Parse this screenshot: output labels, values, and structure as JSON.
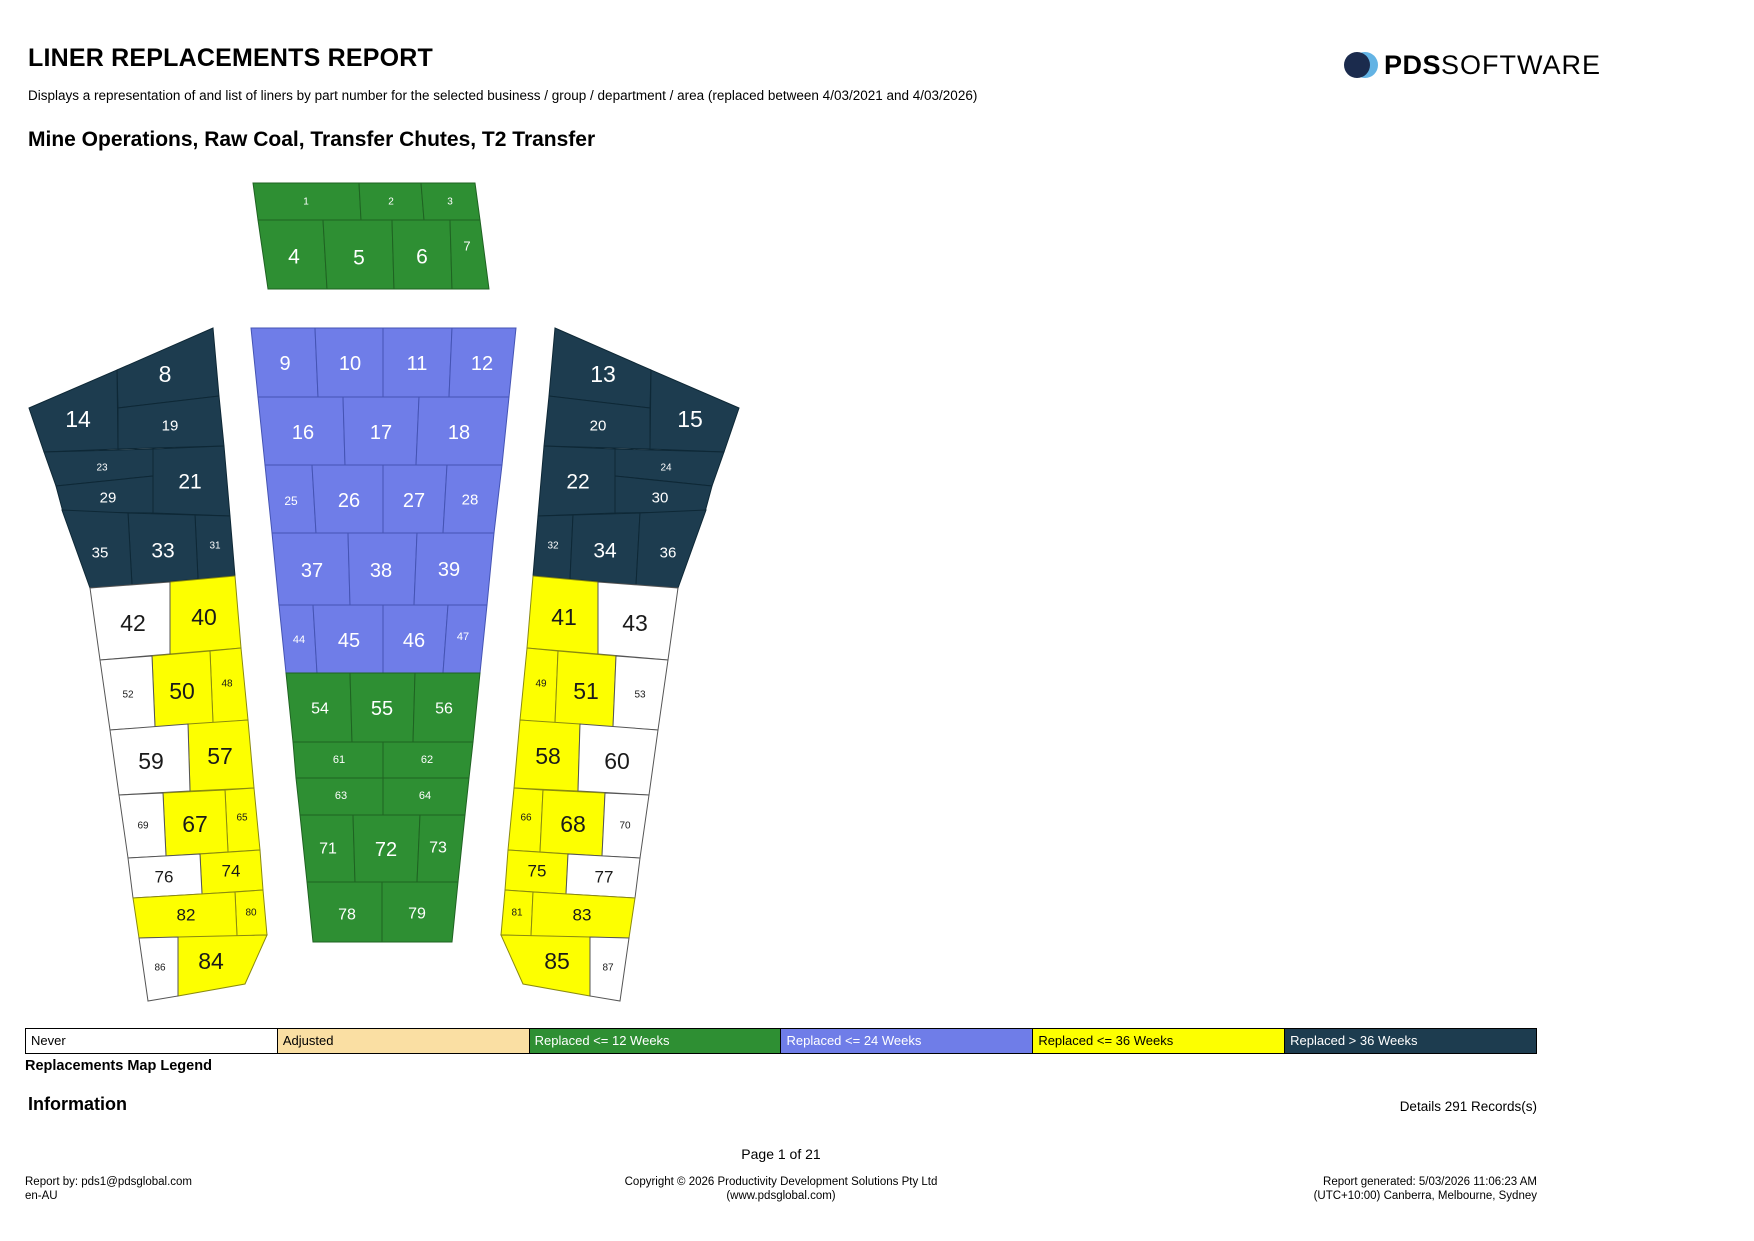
{
  "report": {
    "title": "LINER REPLACEMENTS REPORT",
    "subtitle": "Displays a representation of and list of liners by part number for the selected business / group / department / area (replaced between 4/03/2021 and 4/03/2026)",
    "section_title": "Mine Operations, Raw Coal, Transfer Chutes, T2 Transfer"
  },
  "logo": {
    "pds": "PDS",
    "software": "SOFTWARE",
    "navy": "#1b2b4d",
    "light_blue": "#63b3e4"
  },
  "legend": {
    "title": "Replacements Map Legend",
    "items": [
      {
        "label": "Never",
        "bg": "#ffffff",
        "text": "#000000"
      },
      {
        "label": "Adjusted",
        "bg": "#fadfa3",
        "text": "#000000"
      },
      {
        "label": "Replaced <= 12 Weeks",
        "bg": "#2e8f33",
        "text": "#ffffff"
      },
      {
        "label": "Replaced <= 24 Weeks",
        "bg": "#6f7de8",
        "text": "#ffffff"
      },
      {
        "label": "Replaced <= 36 Weeks",
        "bg": "#fdff00",
        "text": "#000000"
      },
      {
        "label": "Replaced >  36 Weeks",
        "bg": "#1d3c4f",
        "text": "#ffffff"
      }
    ]
  },
  "map": {
    "statuses": {
      "never": "#ffffff",
      "adjusted": "#fadfa3",
      "r12": "#2e8f33",
      "r24": "#6f7de8",
      "r36": "#fdff00",
      "r36plus": "#1d3c4f"
    },
    "cells": [
      {
        "n": 1,
        "status": "r12"
      },
      {
        "n": 2,
        "status": "r12"
      },
      {
        "n": 3,
        "status": "r12"
      },
      {
        "n": 4,
        "status": "r12"
      },
      {
        "n": 5,
        "status": "r12"
      },
      {
        "n": 6,
        "status": "r12"
      },
      {
        "n": 7,
        "status": "r12"
      },
      {
        "n": 8,
        "status": "r36plus"
      },
      {
        "n": 9,
        "status": "r24"
      },
      {
        "n": 10,
        "status": "r24"
      },
      {
        "n": 11,
        "status": "r24"
      },
      {
        "n": 12,
        "status": "r24"
      },
      {
        "n": 13,
        "status": "r36plus"
      },
      {
        "n": 14,
        "status": "r36plus"
      },
      {
        "n": 15,
        "status": "r36plus"
      },
      {
        "n": 16,
        "status": "r24"
      },
      {
        "n": 17,
        "status": "r24"
      },
      {
        "n": 18,
        "status": "r24"
      },
      {
        "n": 19,
        "status": "r36plus"
      },
      {
        "n": 20,
        "status": "r36plus"
      },
      {
        "n": 21,
        "status": "r36plus"
      },
      {
        "n": 22,
        "status": "r36plus"
      },
      {
        "n": 23,
        "status": "r36plus"
      },
      {
        "n": 24,
        "status": "r36plus"
      },
      {
        "n": 25,
        "status": "r24"
      },
      {
        "n": 26,
        "status": "r24"
      },
      {
        "n": 27,
        "status": "r24"
      },
      {
        "n": 28,
        "status": "r24"
      },
      {
        "n": 29,
        "status": "r36plus"
      },
      {
        "n": 30,
        "status": "r36plus"
      },
      {
        "n": 31,
        "status": "r36plus"
      },
      {
        "n": 32,
        "status": "r36plus"
      },
      {
        "n": 33,
        "status": "r36plus"
      },
      {
        "n": 34,
        "status": "r36plus"
      },
      {
        "n": 35,
        "status": "r36plus"
      },
      {
        "n": 36,
        "status": "r36plus"
      },
      {
        "n": 37,
        "status": "r24"
      },
      {
        "n": 38,
        "status": "r24"
      },
      {
        "n": 39,
        "status": "r24"
      },
      {
        "n": 40,
        "status": "r36"
      },
      {
        "n": 41,
        "status": "r36"
      },
      {
        "n": 42,
        "status": "never"
      },
      {
        "n": 43,
        "status": "never"
      },
      {
        "n": 44,
        "status": "r24"
      },
      {
        "n": 45,
        "status": "r24"
      },
      {
        "n": 46,
        "status": "r24"
      },
      {
        "n": 47,
        "status": "r24"
      },
      {
        "n": 48,
        "status": "r36"
      },
      {
        "n": 49,
        "status": "r36"
      },
      {
        "n": 50,
        "status": "r36"
      },
      {
        "n": 51,
        "status": "r36"
      },
      {
        "n": 52,
        "status": "never"
      },
      {
        "n": 53,
        "status": "never"
      },
      {
        "n": 54,
        "status": "r12"
      },
      {
        "n": 55,
        "status": "r12"
      },
      {
        "n": 56,
        "status": "r12"
      },
      {
        "n": 57,
        "status": "r36"
      },
      {
        "n": 58,
        "status": "r36"
      },
      {
        "n": 59,
        "status": "never"
      },
      {
        "n": 60,
        "status": "never"
      },
      {
        "n": 61,
        "status": "r12"
      },
      {
        "n": 62,
        "status": "r12"
      },
      {
        "n": 63,
        "status": "r12"
      },
      {
        "n": 64,
        "status": "r12"
      },
      {
        "n": 65,
        "status": "r36"
      },
      {
        "n": 66,
        "status": "r36"
      },
      {
        "n": 67,
        "status": "r36"
      },
      {
        "n": 68,
        "status": "r36"
      },
      {
        "n": 69,
        "status": "never"
      },
      {
        "n": 70,
        "status": "never"
      },
      {
        "n": 71,
        "status": "r12"
      },
      {
        "n": 72,
        "status": "r12"
      },
      {
        "n": 73,
        "status": "r12"
      },
      {
        "n": 74,
        "status": "r36"
      },
      {
        "n": 75,
        "status": "r36"
      },
      {
        "n": 76,
        "status": "never"
      },
      {
        "n": 77,
        "status": "never"
      },
      {
        "n": 78,
        "status": "r12"
      },
      {
        "n": 79,
        "status": "r12"
      },
      {
        "n": 80,
        "status": "r36"
      },
      {
        "n": 81,
        "status": "r36"
      },
      {
        "n": 82,
        "status": "r36"
      },
      {
        "n": 83,
        "status": "r36"
      },
      {
        "n": 84,
        "status": "r36"
      },
      {
        "n": 85,
        "status": "r36"
      },
      {
        "n": 86,
        "status": "never"
      },
      {
        "n": 87,
        "status": "never"
      }
    ]
  },
  "info": {
    "heading": "Information",
    "details": "Details 291 Records(s)"
  },
  "pagination": {
    "label": "Page 1 of 21"
  },
  "footer": {
    "report_by": "Report by: pds1@pdsglobal.com",
    "locale": "en-AU",
    "copyright": "Copyright © 2026 Productivity Development Solutions Pty Ltd",
    "website": "(www.pdsglobal.com)",
    "generated": "Report generated: 5/03/2026 11:06:23 AM",
    "timezone": "(UTC+10:00) Canberra, Melbourne, Sydney"
  }
}
